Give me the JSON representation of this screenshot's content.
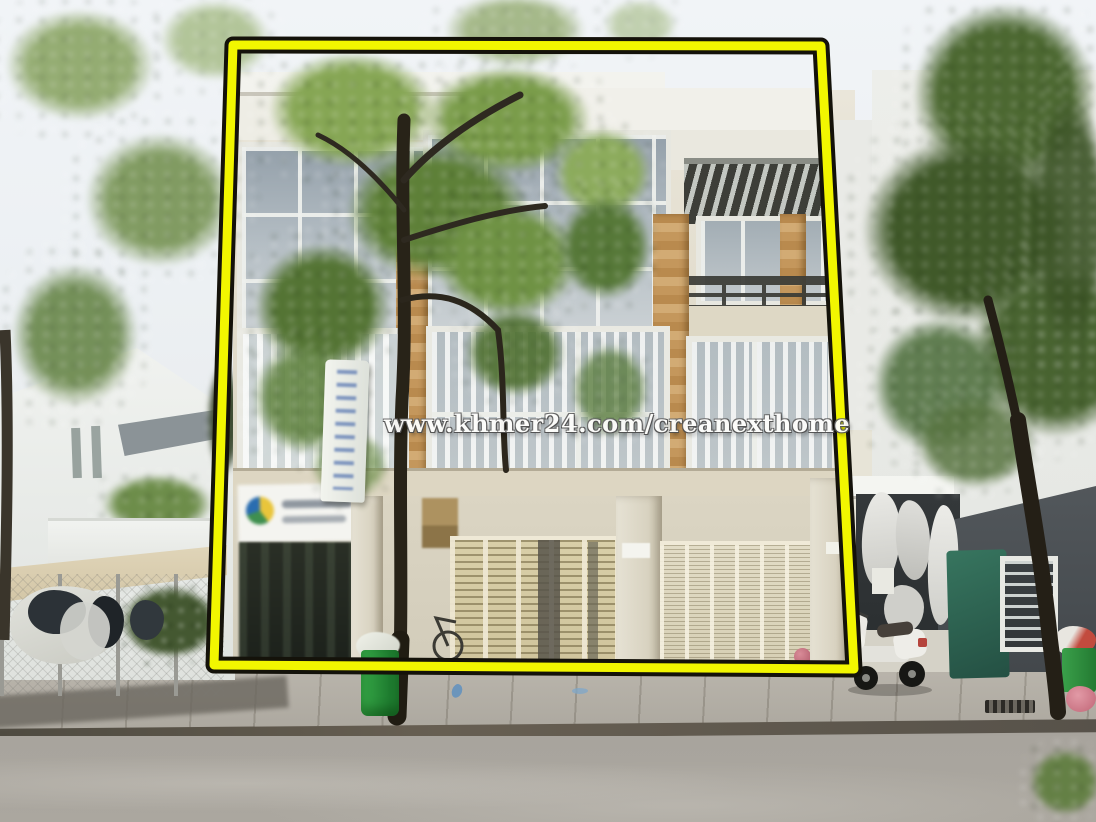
{
  "watermark": {
    "text": "www.khmer24.com/creanexthome"
  },
  "annotation": {
    "type": "highlight-quadrilateral",
    "stroke_color": "#f2f600",
    "outline_color": "#14120a"
  },
  "palette": {
    "sky": "#eff2f5",
    "facade_cream": "#e0dac8",
    "glass_blue": "#9aa7b2",
    "wood_tan": "#c59a62",
    "pergola_dark": "#3f403a",
    "road_gray": "#a6a29b",
    "dark_wall": "#4b5054",
    "tarp_green": "#2f6b57",
    "bin_green": "#2e9e3e",
    "tree_green": "#5d7c38"
  },
  "scene": {
    "description": "Street photo of a four-storey flat house highlighted with a yellow border; khmer24 real-estate watermark across the centre",
    "objects": [
      "main-flat-house",
      "yellow-highlight-frame",
      "street-tree",
      "khmer-banner-sign",
      "blurred-shop-sign",
      "folding-shutter-doors",
      "left-house",
      "laundry-fence",
      "right-house",
      "hanging-laundry",
      "green-tarp",
      "parked-scooter",
      "green-trash-bin",
      "pink-basket",
      "concrete-road"
    ]
  }
}
